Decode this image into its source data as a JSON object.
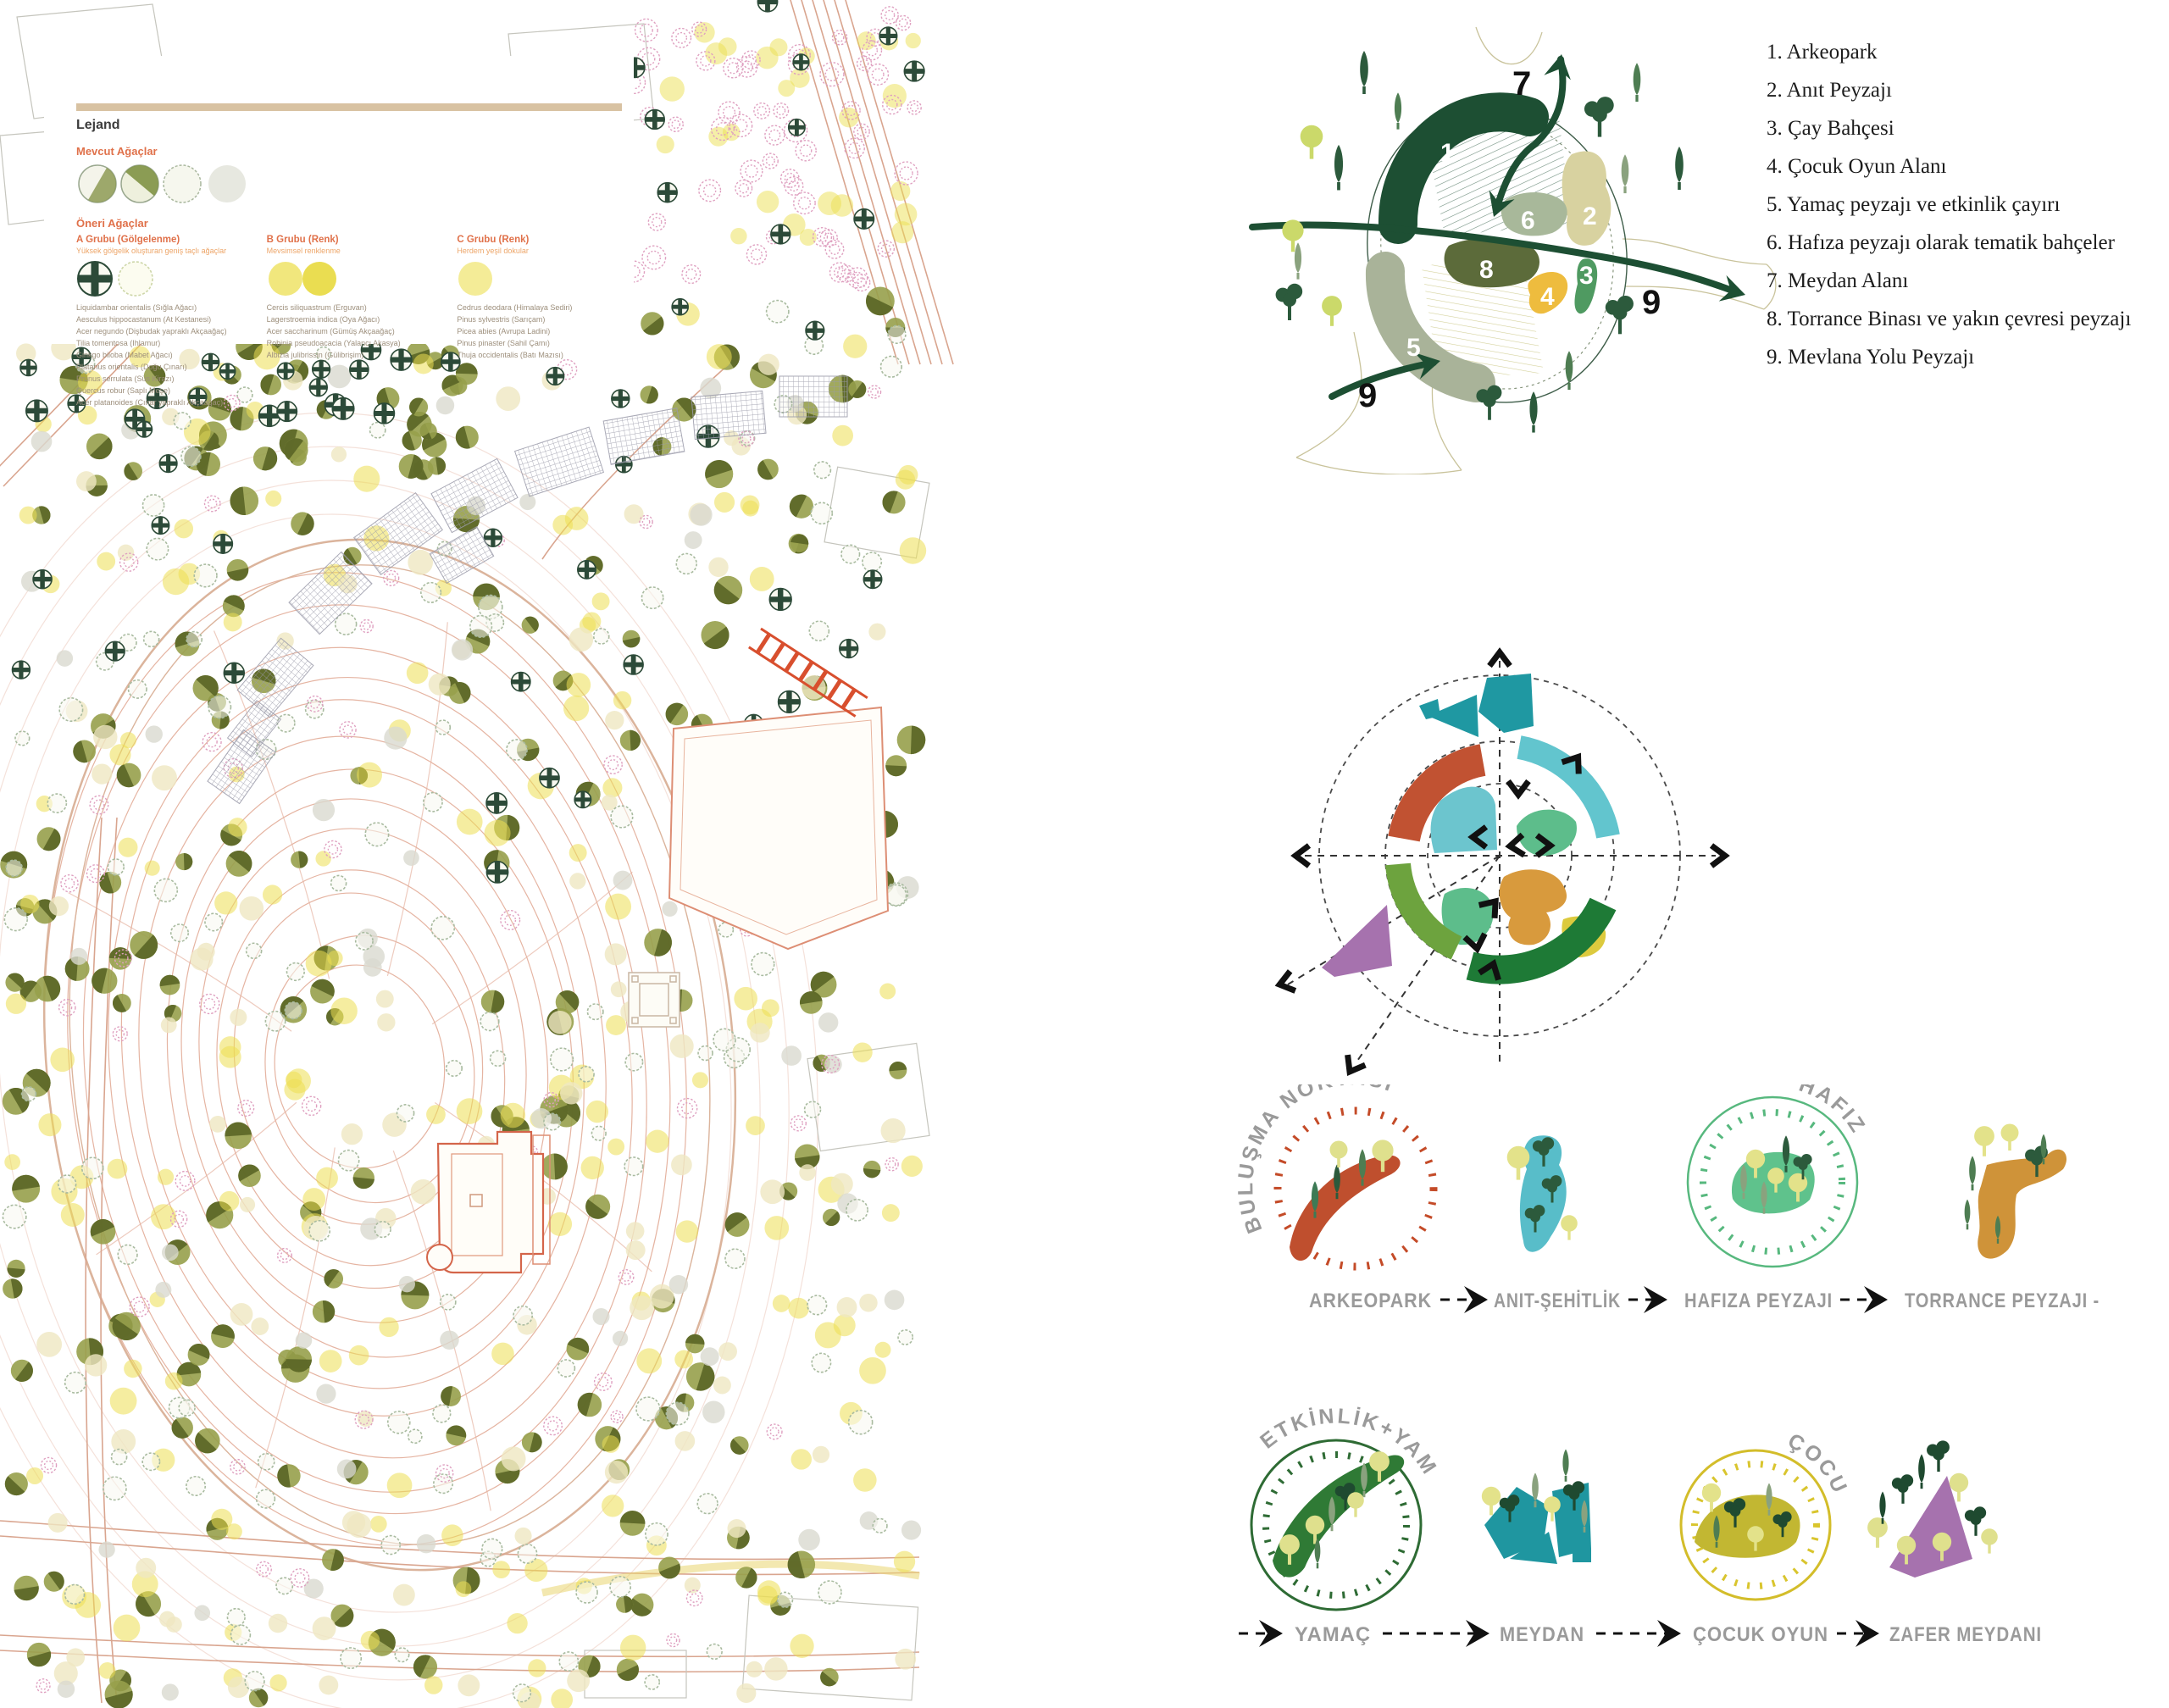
{
  "legend": {
    "title": "Lejand",
    "existing_title": "Mevcut Ağaçlar",
    "proposed_title": "Öneri Ağaçlar",
    "groups": [
      {
        "title": "A Grubu (Gölgelenme)",
        "sub": "Yüksek gölgelik oluşturan geniş taçlı ağaçlar",
        "species": "Liquidambar orientalis (Sığla Ağacı)\nAesculus hippocastanum (At Kestanesi)\nAcer negundo (Dişbudak yapraklı Akçaağaç)\nTilia tomentosa (Ihlamur)\nGinkgo biloba (Mabet Ağacı)\nPlatanus orientalis (Doğu Çınarı)\nPrunus serrulata (Süs Kirazı)\nQuercus robur (Saplı Meşe)\nAcer platanoides (Çınar yapraklı Akçaağaç)"
      },
      {
        "title": "B Grubu (Renk)",
        "sub": "Mevsimsel renklenme",
        "species": "Cercis siliquastrum (Erguvan)\nLagerstroemia indica (Oya Ağacı)\nAcer saccharinum (Gümüş Akçaağaç)\nRobinia pseudoacacia (Yalancı Akasya)\nAlbizia julibrissin (Gülibrişim)"
      },
      {
        "title": "C Grubu (Renk)",
        "sub": "Herdem yeşil dokular",
        "species": "Cedrus deodara (Himalaya Sediri)\nPinus sylvestris (Sarıçam)\nPicea abies (Avrupa Ladini)\nPinus pinaster (Sahil Çamı)\nThuja occidentalis (Batı Mazısı)"
      }
    ]
  },
  "program_list": {
    "items": [
      "1. Arkeopark",
      "2. Anıt Peyzajı",
      "3. Çay Bahçesi",
      "4. Çocuk Oyun Alanı",
      "5. Yamaç peyzajı ve etkinlik çayırı",
      "6. Hafıza peyzajı olarak tematik bahçeler",
      "7. Meydan Alanı",
      "8. Torrance Binası ve yakın çevresi peyzajı",
      "9. Mevlana Yolu Peyzajı"
    ]
  },
  "zone_diagram": {
    "zone_numbers": {
      "z1": "1",
      "z2": "2",
      "z3": "3",
      "z4": "4",
      "z5": "5",
      "z6": "6",
      "z8": "8"
    },
    "outer_labels": {
      "top": "7",
      "right": "9",
      "bottom_left": "9"
    }
  },
  "sequences": {
    "row1": {
      "badge_left": "BULUŞMA NOKTASI",
      "badge_right": "HAFIZA",
      "steps": [
        "ARKEOPARK",
        "ANIT-ŞEHİTLİK",
        "HAFIZA PEYZAJI",
        "TORRANCE PEYZAJI -"
      ]
    },
    "row2": {
      "badge_left": "ETKİNLİK+YAMAÇ",
      "badge_right": "ÇOCUK",
      "steps": [
        "YAMAÇ",
        "MEYDAN",
        "ÇOCUK OYUN",
        "ZAFER MEYDANI"
      ]
    }
  },
  "colors": {
    "contour": "#dfa28b",
    "legend_bar": "#d8c2a2",
    "zone_dark_green": "#1d4f33",
    "zone_khaki": "#d8d2a0",
    "zone_mid_green": "#4f9a61",
    "zone_yellow": "#eebc3e",
    "zone_sage": "#a9b399",
    "zone_olive": "#5c6b3a",
    "radial_teal": "#1f98a2",
    "radial_red": "#c15232",
    "radial_cyan": "#62c5ce",
    "radial_soft_green": "#5dbd8b",
    "radial_orange": "#d89a3d",
    "radial_yellow": "#dcca3e",
    "radial_leaf_green": "#6da33e",
    "radial_dark_green": "#1e7a36",
    "radial_purple": "#a672ae",
    "seq_red": "#bf4f2e",
    "seq_cyan": "#58bdc9",
    "seq_green": "#5fc28c",
    "seq_orange": "#cf9339",
    "seq_dark_green": "#2f7a35",
    "seq_teal": "#1f96a0",
    "seq_yellow": "#c2b732",
    "seq_purple": "#a672ae",
    "label_gray": "#9a9a9a"
  },
  "map_spec": {
    "tree_layers": [
      {
        "name": "olive-canopy",
        "type": "canopy",
        "fill": "#97a04b",
        "shadow": "#5a6526",
        "count": 200,
        "x": [
          10,
          1080
        ],
        "y": [
          320,
          2010
        ],
        "r": [
          10,
          17
        ]
      },
      {
        "name": "olive-canopy-road",
        "type": "canopy",
        "fill": "#97a04b",
        "shadow": "#5a6526",
        "count": 25,
        "x": [
          230,
          560
        ],
        "y": [
          380,
          560
        ],
        "r": [
          10,
          15
        ]
      },
      {
        "name": "yellow-bloom",
        "type": "flat",
        "fill": "#ecdf52",
        "opacity": 0.55,
        "count": 170,
        "x": [
          10,
          1080
        ],
        "y": [
          300,
          2010
        ],
        "r": [
          9,
          16
        ]
      },
      {
        "name": "yellow-bloom-top",
        "type": "flat",
        "fill": "#ecdf52",
        "opacity": 0.5,
        "count": 40,
        "x": [
          560,
          1080
        ],
        "y": [
          20,
          320
        ],
        "r": [
          9,
          15
        ]
      },
      {
        "name": "cream-canopy",
        "type": "flat",
        "fill": "#efe7c2",
        "opacity": 0.8,
        "count": 110,
        "x": [
          10,
          1080
        ],
        "y": [
          300,
          2010
        ],
        "r": [
          9,
          15
        ]
      },
      {
        "name": "gray-canopy",
        "type": "flat",
        "fill": "#d9d9d0",
        "opacity": 0.8,
        "count": 55,
        "x": [
          10,
          1080
        ],
        "y": [
          300,
          2010
        ],
        "r": [
          9,
          14
        ]
      },
      {
        "name": "sage-outline",
        "type": "ring",
        "stroke": "#a9bba0",
        "count": 140,
        "x": [
          10,
          1080
        ],
        "y": [
          300,
          2010
        ],
        "r": [
          8,
          14
        ]
      },
      {
        "name": "pink-blossom-top",
        "type": "pinkhatch",
        "stroke": "#dfa0c0",
        "count": 95,
        "x": [
          540,
          1080
        ],
        "y": [
          10,
          340
        ],
        "r": [
          8,
          14
        ]
      },
      {
        "name": "pink-blossom",
        "type": "pinkhatch",
        "stroke": "#dfa0c0",
        "count": 55,
        "x": [
          10,
          1080
        ],
        "y": [
          340,
          2010
        ],
        "r": [
          7,
          12
        ]
      },
      {
        "name": "conifer-cross-road",
        "type": "cross",
        "stroke": "#2c4a38",
        "count": 22,
        "x": [
          0,
          560
        ],
        "y": [
          390,
          500
        ],
        "r": [
          9,
          13
        ]
      },
      {
        "name": "conifer-cross",
        "type": "cross",
        "stroke": "#2c4a38",
        "count": 34,
        "x": [
          560,
          1080
        ],
        "y": [
          0,
          1100
        ],
        "r": [
          9,
          13
        ]
      },
      {
        "name": "conifer-cross-left",
        "type": "cross",
        "stroke": "#2c4a38",
        "count": 8,
        "x": [
          0,
          300
        ],
        "y": [
          500,
          800
        ],
        "r": [
          9,
          12
        ]
      }
    ]
  }
}
